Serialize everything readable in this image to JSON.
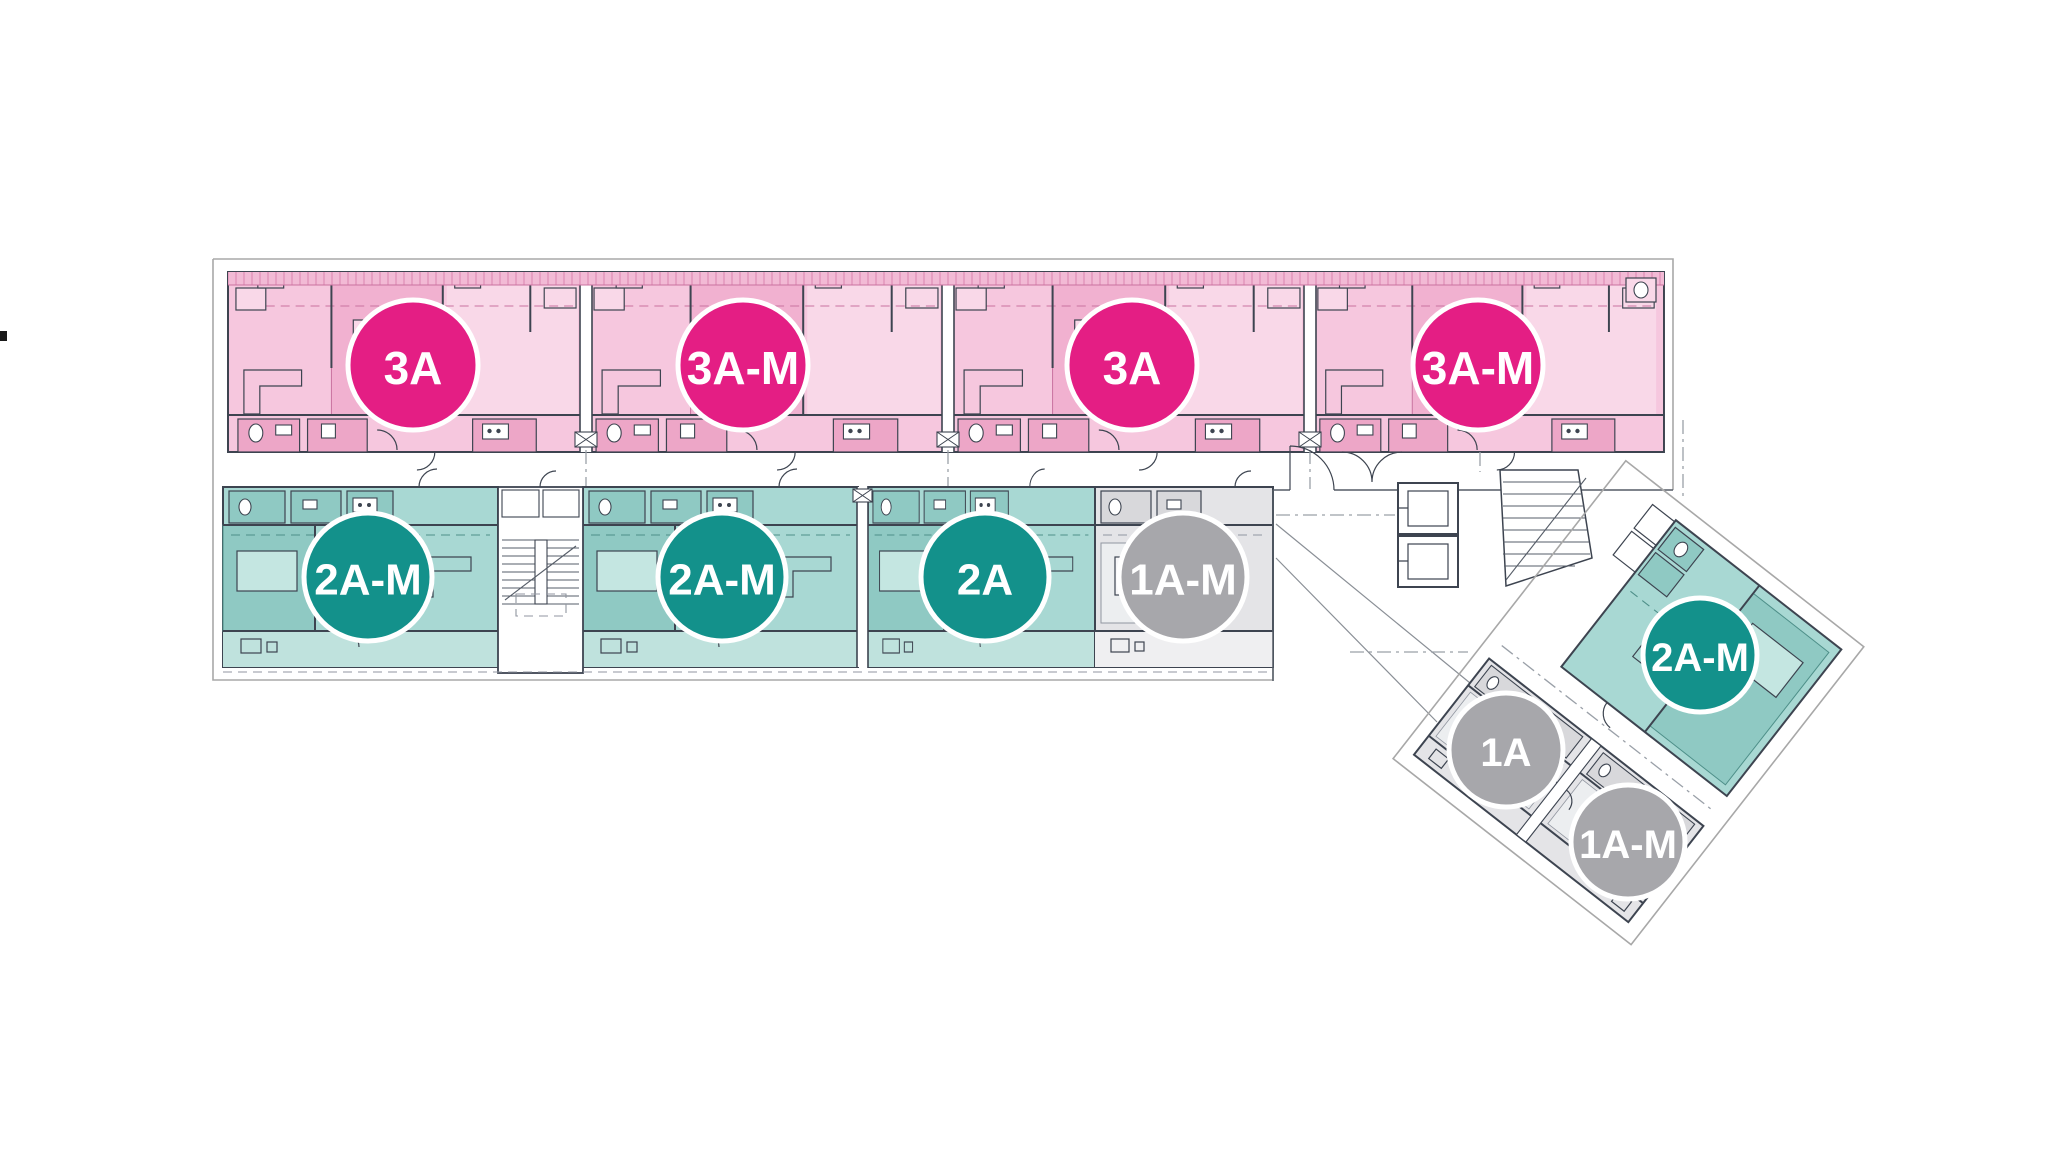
{
  "palette": {
    "magenta": "#e41e84",
    "teal": "#13918b",
    "gray": "#a7a7ab",
    "pink_area": "#f6c7de",
    "teal_area": "#a8d8d3",
    "gray_area": "#e4e4e7",
    "wall": "#3d4450",
    "outline": "#a8a8a8",
    "background": "#ffffff"
  },
  "badges": [
    {
      "label": "3A",
      "variant": "magenta"
    },
    {
      "label": "3A-M",
      "variant": "magenta"
    },
    {
      "label": "3A",
      "variant": "magenta"
    },
    {
      "label": "3A-M",
      "variant": "magenta"
    },
    {
      "label": "2A-M",
      "variant": "teal"
    },
    {
      "label": "2A-M",
      "variant": "teal"
    },
    {
      "label": "2A",
      "variant": "teal"
    },
    {
      "label": "1A-M",
      "variant": "gray"
    },
    {
      "label": "1A",
      "variant": "gray"
    },
    {
      "label": "1A-M",
      "variant": "gray"
    },
    {
      "label": "2A-M",
      "variant": "teal"
    }
  ]
}
